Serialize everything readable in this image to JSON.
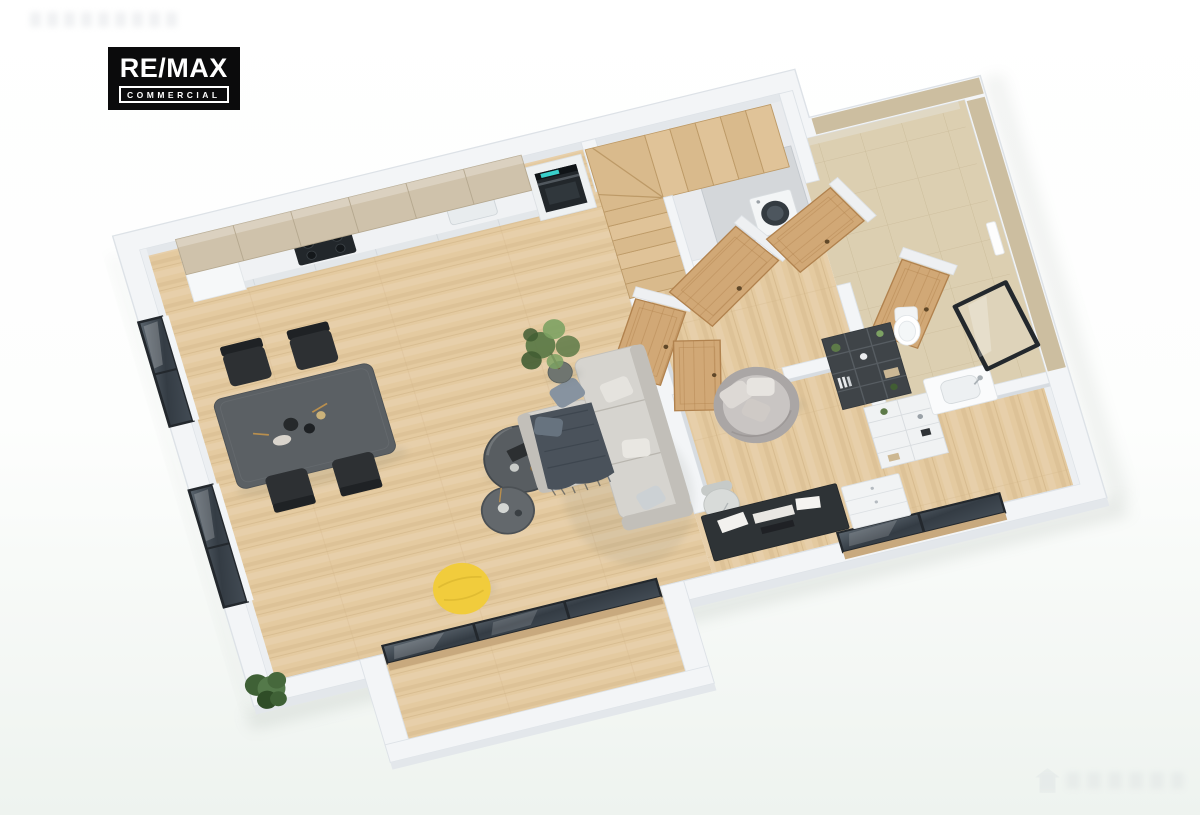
{
  "scene": {
    "kind": "isometric-3d-floor-plan",
    "label": "3D cutaway floor plan rendering of an apartment"
  },
  "logo": {
    "line1": "RE/MAX",
    "line2": "COMMERCIAL",
    "background": "#0b0b0c",
    "foreground": "#ffffff"
  },
  "watermarks": {
    "top_left_legible": false,
    "bottom_right_legible": false
  },
  "colors": {
    "bg-top": "#ffffff",
    "bg-bottom": "#eef3ef",
    "wall-top": "#f3f5f7",
    "wall-side": "#e3e7eb",
    "wall-shade": "#d7dce1",
    "wall-edge": "#dde2e7",
    "floor-wood": "#e4caa0",
    "floor-wood-dark": "#cfb183",
    "floor-wood-light": "#f0ddba",
    "gray-floor": "#e9ebee",
    "stair-wood": "#d9ba8c",
    "stair-wood-dark": "#bd9a67",
    "door-wood": "#d1a876",
    "door-wood-dark": "#b1824e",
    "cab-wood": "#cfc2ab",
    "cab-wood-dark": "#b5a88f",
    "counter-white": "#f0f2f4",
    "appliance-dark": "#22272b",
    "oven-display": "#39cfca",
    "table-dark": "#5b6064",
    "chair-black": "#2d3033",
    "sofa-gray": "#d6d4cf",
    "sofa-dark": "#c2bfb9",
    "blanket-dark": "#4a525b",
    "pillow-blue": "#8793a0",
    "pillow-light": "#e5e3de",
    "pouf-yellow": "#f1cc3c",
    "plant-green": "#5d7a48",
    "plant-green-dark": "#415d33",
    "plant-green-light": "#7da263",
    "tile-beige": "#dccfb1",
    "tile-beige-dark": "#c4b491",
    "mirror-glass": "#ded3ba",
    "frame-black": "#23282d",
    "glass-dark": "#3e474f",
    "closet-gray": "#d4d7da",
    "shelf-dark": "#3f4448",
    "shelf-white": "#f0f2f3",
    "fixture-white": "#fafbfc",
    "shadow-tint": "#7f8b80"
  }
}
